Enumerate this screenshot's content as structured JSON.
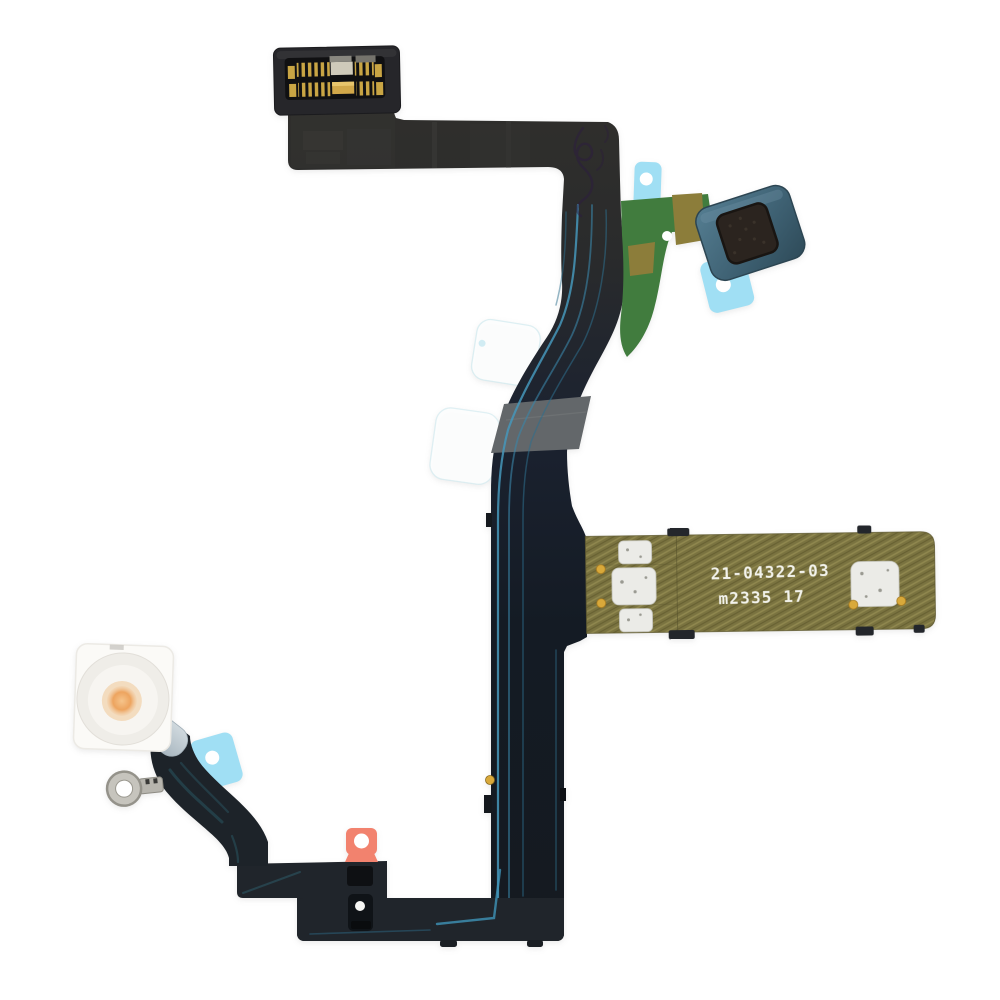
{
  "page": {
    "description": "Product photo of a smartphone flashlight / power-button flex cable on a white background",
    "background_color": "#ffffff"
  },
  "pcb_label": {
    "line1": "21-04322-03",
    "line2": "m2335 17",
    "text_color": "#f3f3ec"
  },
  "colors": {
    "flex_dark": "#2e2d2a",
    "flex_navy": "#161d26",
    "trace_blue": "#4596ba",
    "trace_blue_dim": "#2e6f8e",
    "gray_band": "#63676a",
    "green_pcb": "#417c3e",
    "olive_gold": "#8c7d3a",
    "gold_strip": "#7a7340",
    "pad_silver": "#ebebe7",
    "gold_via": "#d9a93a",
    "adhesive_blue": "#a0dff4",
    "clear_tab": "#fdfefe",
    "pull_tab_orange": "#f2826e",
    "diffuser_white": "#fbfaf7",
    "lens_ring": "#efede8",
    "led_amber": "#e89a57",
    "stem_gray": "#bcc8d0",
    "ring_metal": "#c6c4bd",
    "connector_body": "#26262a",
    "pin_gold": "#c9a544",
    "marking_purple": "#2b1b40"
  }
}
